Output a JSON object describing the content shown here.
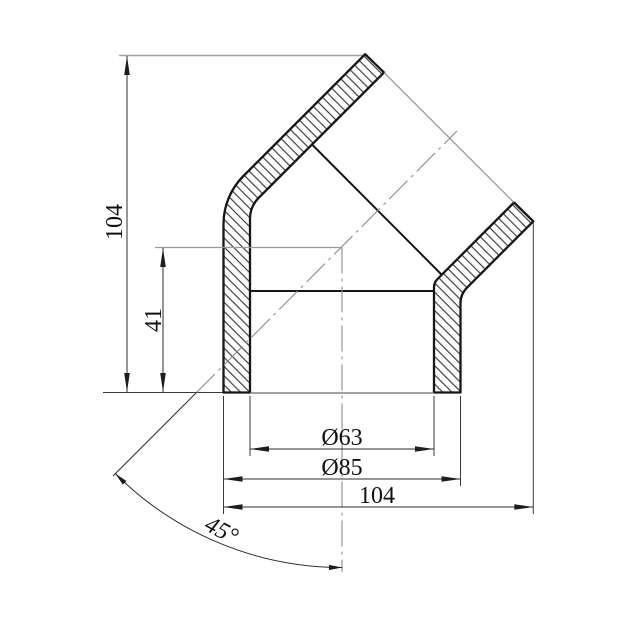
{
  "drawing": {
    "type": "technical-drawing",
    "subject": "45-degree elbow pipe fitting, sectional view with dimensions",
    "background_color": "#ffffff",
    "outline_color": "#161616",
    "dimension_line_color": "#3a3a3a",
    "construction_line_color": "#9a9a9a",
    "dimensions": {
      "overall_height": "104",
      "socket_offset": "41",
      "inner_diameter": "Ø63",
      "outer_diameter": "Ø85",
      "overall_width": "104",
      "bend_angle": "45°"
    }
  }
}
